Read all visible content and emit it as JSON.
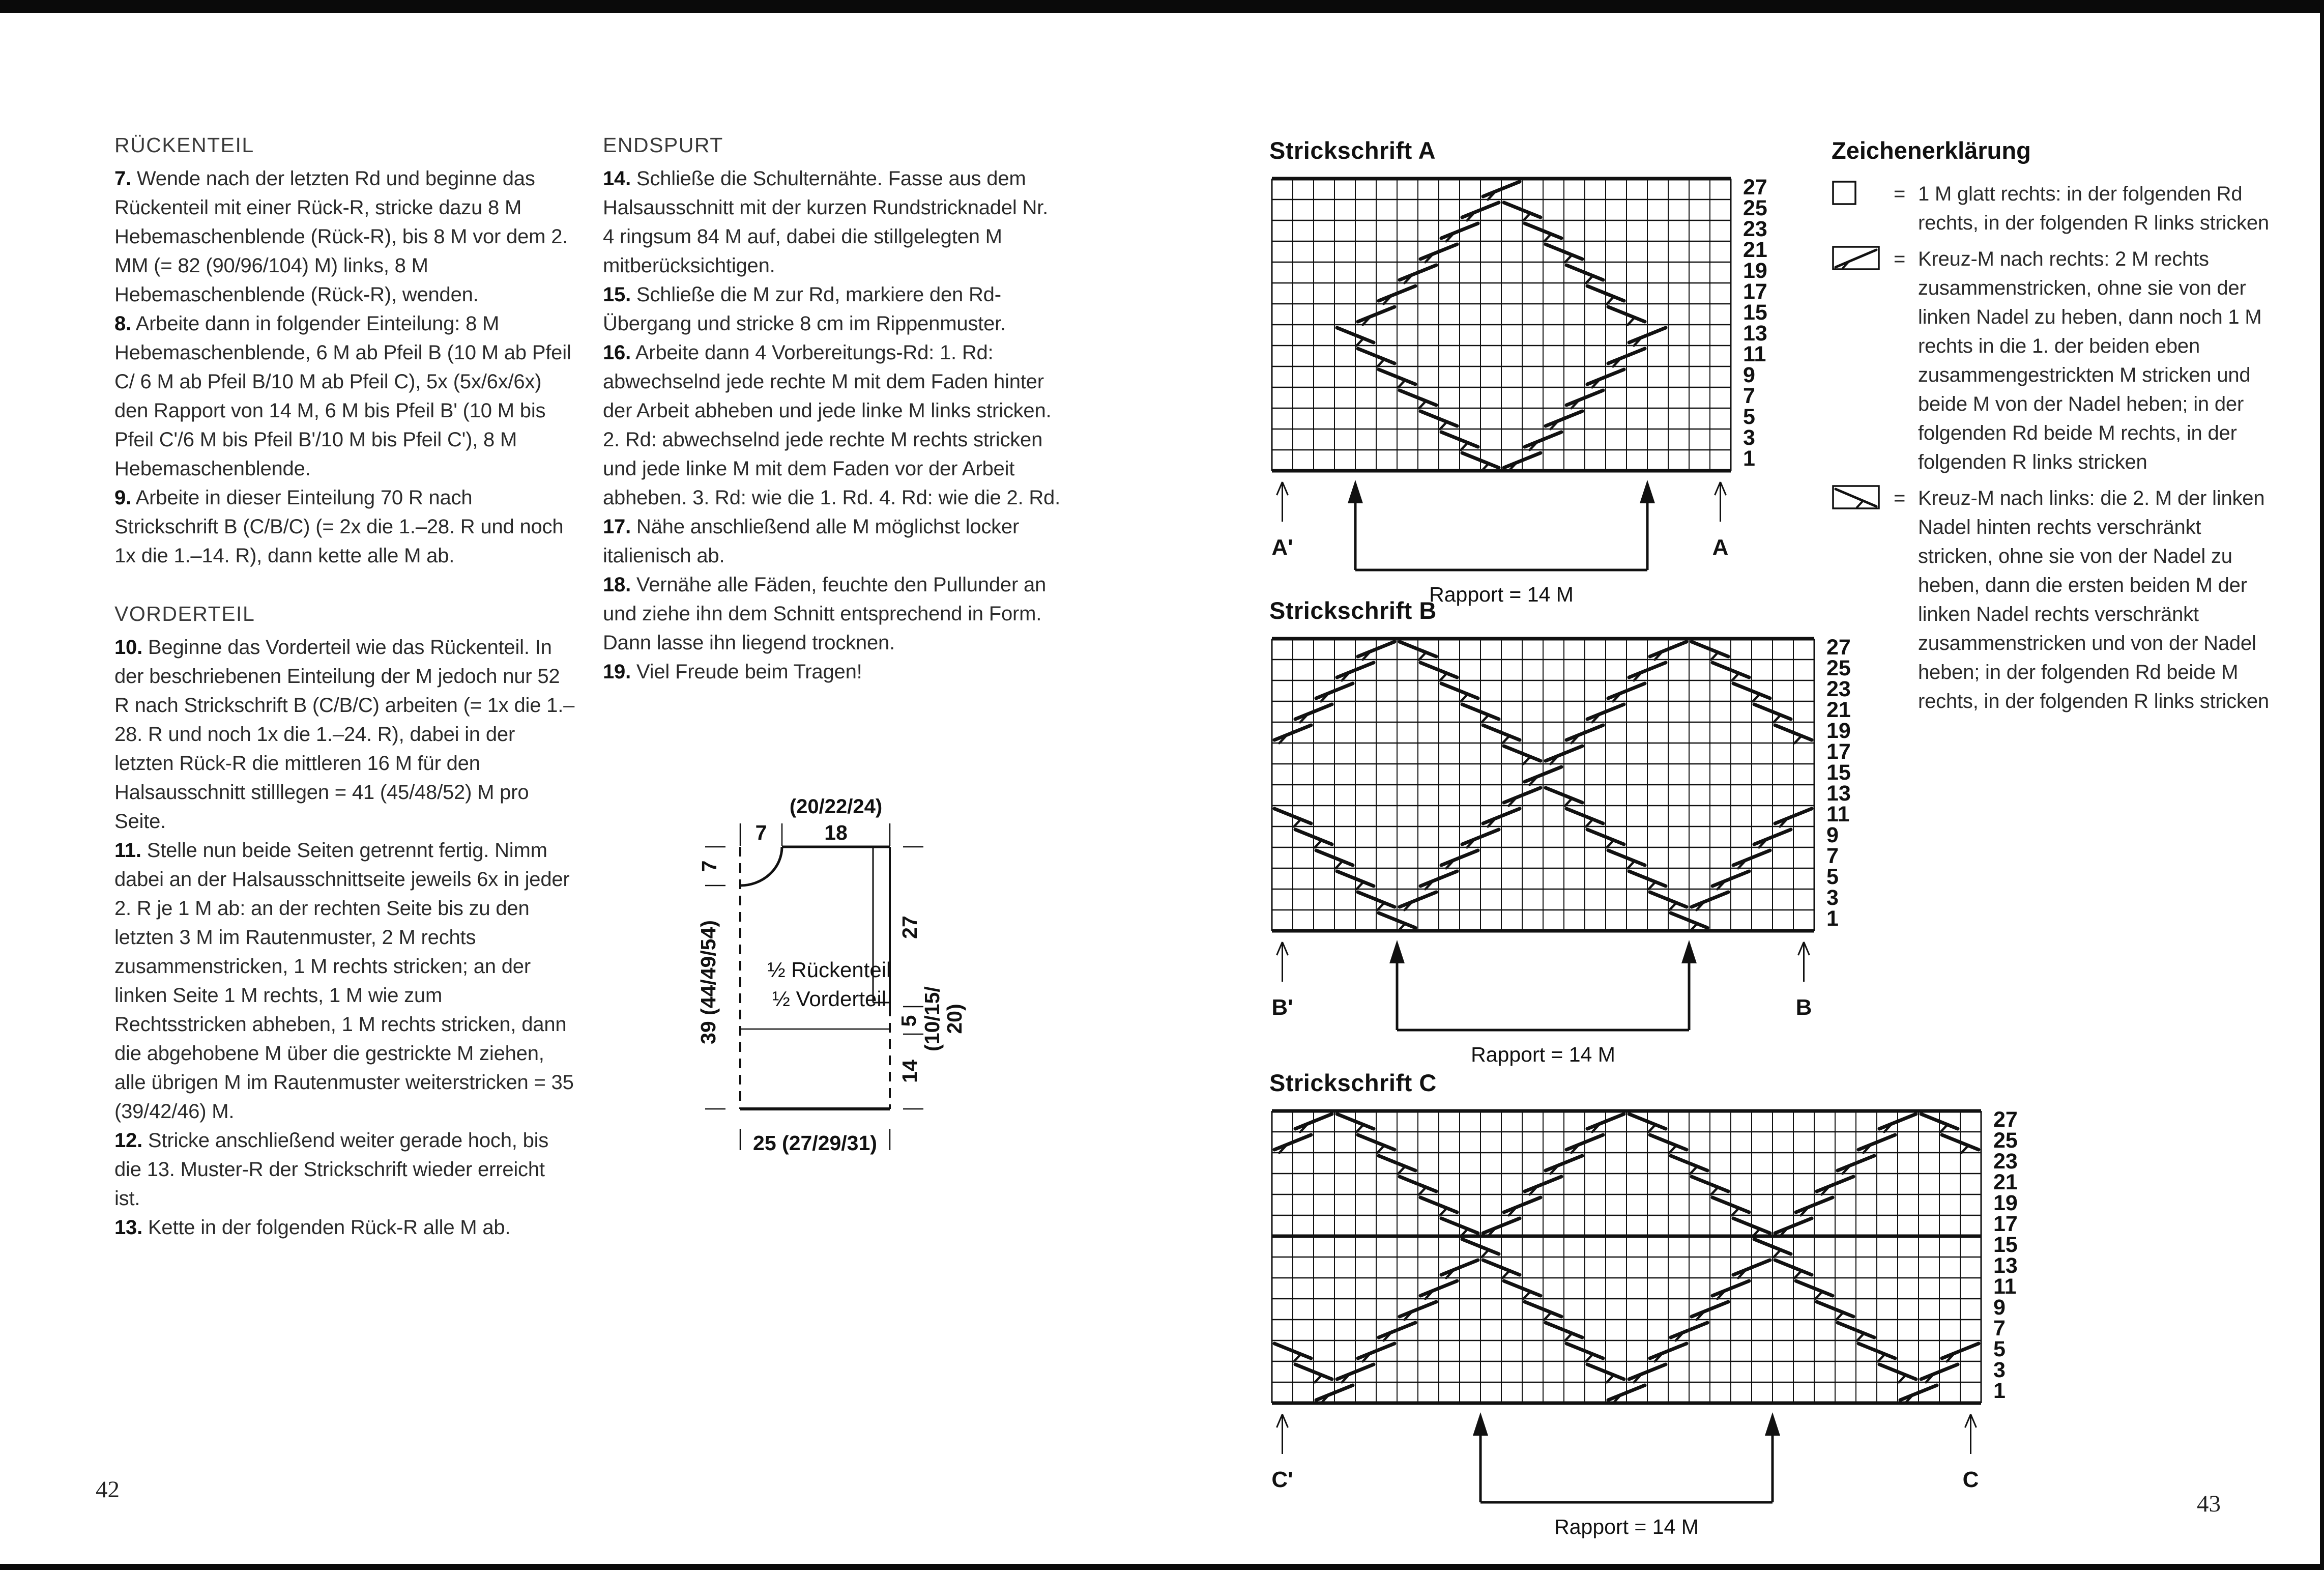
{
  "page_left": {
    "number": "42",
    "sections": [
      {
        "heading": "RÜCKENTEIL",
        "steps": [
          {
            "num": "7.",
            "text": "Wende nach der letzten Rd und beginne das Rückenteil mit einer Rück-R, stricke dazu 8 M Hebemaschenblende (Rück-R), bis 8 M vor dem 2. MM (= 82 (90/96/104) M) links, 8 M Hebemaschenblende (Rück-R), wenden."
          },
          {
            "num": "8.",
            "text": "Arbeite dann in folgender Einteilung: 8 M Hebemaschenblende, 6 M ab Pfeil B (10 M ab Pfeil C/ 6 M ab Pfeil B/10 M ab Pfeil C), 5x (5x/6x/6x) den Rapport von 14 M, 6 M bis Pfeil B' (10 M bis Pfeil C'/6 M bis Pfeil B'/10 M bis Pfeil C'), 8 M Hebemaschenblende."
          },
          {
            "num": "9.",
            "text": "Arbeite in dieser Einteilung 70 R nach Strickschrift B (C/B/C) (= 2x die 1.–28. R und noch 1x die 1.–14. R), dann kette alle M ab."
          }
        ]
      },
      {
        "heading": "VORDERTEIL",
        "steps": [
          {
            "num": "10.",
            "text": "Beginne das Vorderteil wie das Rückenteil. In der beschriebenen Einteilung der M jedoch nur 52 R nach Strickschrift B (C/B/C) arbeiten (= 1x die 1.–28. R und noch 1x die 1.–24. R), dabei in der letzten Rück-R die mittleren 16 M für den Halsausschnitt stilllegen = 41 (45/48/52) M pro Seite."
          },
          {
            "num": "11.",
            "text": "Stelle nun beide Seiten getrennt fertig. Nimm dabei an der Halsausschnittseite jeweils 6x in jeder 2. R je 1 M ab: an der rechten Seite bis zu den letzten 3 M im Rautenmuster, 2 M rechts zusammenstricken, 1 M rechts stricken; an der linken Seite 1 M rechts, 1 M wie zum Rechtsstricken abheben, 1 M rechts stricken, dann die abgehobene M über die gestrickte M ziehen, alle übrigen M im Rautenmuster weiterstricken = 35 (39/42/46) M."
          },
          {
            "num": "12.",
            "text": "Stricke anschließend weiter gerade hoch, bis die 13. Muster-R der Strickschrift wieder erreicht ist."
          },
          {
            "num": "13.",
            "text": "Kette in der folgenden Rück-R alle M ab."
          }
        ]
      }
    ]
  },
  "page_mid": {
    "sections": [
      {
        "heading": "ENDSPURT",
        "steps": [
          {
            "num": "14.",
            "text": "Schließe die Schulternähte. Fasse aus dem Halsausschnitt mit der kurzen Rundstricknadel Nr. 4 ringsum 84 M auf, dabei die stillgelegten M mitberücksichtigen."
          },
          {
            "num": "15.",
            "text": "Schließe die M zur Rd, markiere den Rd-Übergang und stricke 8 cm im Rippenmuster."
          },
          {
            "num": "16.",
            "text": "Arbeite dann 4 Vorbereitungs-Rd: 1. Rd: abwechselnd jede rechte M mit dem Faden hinter der Arbeit abheben und jede linke M links stricken. 2. Rd: abwechselnd jede rechte M rechts stricken und jede linke M mit dem Faden vor der Arbeit abheben. 3. Rd: wie die 1. Rd. 4. Rd: wie die 2. Rd."
          },
          {
            "num": "17.",
            "text": "Nähe anschließend alle M möglichst locker italienisch ab."
          },
          {
            "num": "18.",
            "text": "Vernähe alle Fäden, feuchte den Pullunder an und ziehe ihn dem Schnitt entsprechend in Form. Dann lasse ihn liegend trocknen."
          },
          {
            "num": "19.",
            "text": "Viel Freude beim Tragen!"
          }
        ]
      }
    ]
  },
  "schematic": {
    "top_group": "(20/22/24)",
    "top_width": "18",
    "top_left": "7",
    "left_small": "7",
    "left_total": "39 (44/49/54)",
    "right_upper": "27",
    "right_mid_num": "5",
    "right_mid_paren1": "(10/15/",
    "right_mid_paren2": "20)",
    "right_lower": "14",
    "bottom": "25 (27/29/31)",
    "inner_line1": "½ Rückenteil",
    "inner_line2": "½ Vorderteil"
  },
  "page_right": {
    "number": "43",
    "legend": {
      "title": "Zeichenerklärung",
      "items": [
        {
          "symbol": "empty-square",
          "eq": "=",
          "text": "1 M glatt rechts: in der folgenden Rd rechts, in der folgenden R links stricken"
        },
        {
          "symbol": "cross-right",
          "eq": "=",
          "text": "Kreuz-M nach rechts: 2 M rechts zusammenstricken, ohne sie von der linken Nadel zu heben, dann noch 1 M rechts in die 1. der beiden eben zusammengestrickten M stricken und beide M von der Nadel heben; in der folgenden Rd beide M rechts, in der folgenden R links stricken"
        },
        {
          "symbol": "cross-left",
          "eq": "=",
          "text": "Kreuz-M nach links: die 2. M der linken Nadel hinten rechts verschränkt stricken, ohne sie von der Nadel zu heben, dann die ersten beiden M der linken Nadel rechts verschränkt zusammenstricken und von der Nadel heben; in der folgenden Rd beide M rechts, in der folgenden R links stricken"
        }
      ]
    },
    "charts": [
      {
        "id": "A",
        "title": "Strickschrift A",
        "pos": [
          2495,
          268
        ],
        "cols": 22,
        "rows": [
          27,
          25,
          23,
          21,
          19,
          17,
          15,
          13,
          11,
          9,
          7,
          5,
          3,
          1
        ],
        "arrow_labels": [
          "A'",
          "A"
        ],
        "rapport_bounds": [
          4,
          18
        ],
        "rapport_label": "Rapport = 14 M",
        "strokes": [
          [
            27,
            11,
            "r"
          ],
          [
            25,
            10,
            "r"
          ],
          [
            25,
            12,
            "l"
          ],
          [
            23,
            9,
            "r"
          ],
          [
            23,
            13,
            "l"
          ],
          [
            21,
            8,
            "r"
          ],
          [
            21,
            14,
            "l"
          ],
          [
            19,
            7,
            "r"
          ],
          [
            19,
            15,
            "l"
          ],
          [
            17,
            6,
            "r"
          ],
          [
            17,
            16,
            "l"
          ],
          [
            15,
            5,
            "r"
          ],
          [
            15,
            17,
            "l"
          ],
          [
            13,
            4,
            "l"
          ],
          [
            13,
            18,
            "r"
          ],
          [
            11,
            5,
            "l"
          ],
          [
            11,
            17,
            "r"
          ],
          [
            9,
            6,
            "l"
          ],
          [
            9,
            16,
            "r"
          ],
          [
            7,
            7,
            "l"
          ],
          [
            7,
            15,
            "r"
          ],
          [
            5,
            8,
            "l"
          ],
          [
            5,
            14,
            "r"
          ],
          [
            3,
            9,
            "l"
          ],
          [
            3,
            13,
            "r"
          ],
          [
            1,
            10,
            "l"
          ],
          [
            1,
            12,
            "r"
          ]
        ]
      },
      {
        "id": "B",
        "title": "Strickschrift B",
        "pos": [
          2495,
          1172
        ],
        "cols": 26,
        "rows": [
          27,
          25,
          23,
          21,
          19,
          17,
          15,
          13,
          11,
          9,
          7,
          5,
          3,
          1
        ],
        "arrow_labels": [
          "B'",
          "B"
        ],
        "rapport_bounds": [
          6,
          20
        ],
        "rapport_label": "Rapport = 14 M",
        "strokes": [
          [
            27,
            5,
            "r"
          ],
          [
            27,
            7,
            "l"
          ],
          [
            27,
            19,
            "r"
          ],
          [
            27,
            21,
            "l"
          ],
          [
            25,
            4,
            "r"
          ],
          [
            25,
            8,
            "l"
          ],
          [
            25,
            18,
            "r"
          ],
          [
            25,
            22,
            "l"
          ],
          [
            23,
            3,
            "r"
          ],
          [
            23,
            9,
            "l"
          ],
          [
            23,
            17,
            "r"
          ],
          [
            23,
            23,
            "l"
          ],
          [
            21,
            2,
            "r"
          ],
          [
            21,
            10,
            "l"
          ],
          [
            21,
            16,
            "r"
          ],
          [
            21,
            24,
            "l"
          ],
          [
            19,
            1,
            "r"
          ],
          [
            19,
            11,
            "l"
          ],
          [
            19,
            15,
            "r"
          ],
          [
            19,
            25,
            "l"
          ],
          [
            17,
            12,
            "l"
          ],
          [
            17,
            14,
            "r"
          ],
          [
            15,
            13,
            "r"
          ],
          [
            13,
            12,
            "r"
          ],
          [
            13,
            14,
            "l"
          ],
          [
            11,
            1,
            "l"
          ],
          [
            11,
            11,
            "r"
          ],
          [
            11,
            15,
            "l"
          ],
          [
            11,
            25,
            "r"
          ],
          [
            9,
            2,
            "l"
          ],
          [
            9,
            10,
            "r"
          ],
          [
            9,
            16,
            "l"
          ],
          [
            9,
            24,
            "r"
          ],
          [
            7,
            3,
            "l"
          ],
          [
            7,
            9,
            "r"
          ],
          [
            7,
            17,
            "l"
          ],
          [
            7,
            23,
            "r"
          ],
          [
            5,
            4,
            "l"
          ],
          [
            5,
            8,
            "r"
          ],
          [
            5,
            18,
            "l"
          ],
          [
            5,
            22,
            "r"
          ],
          [
            3,
            5,
            "l"
          ],
          [
            3,
            7,
            "r"
          ],
          [
            3,
            19,
            "l"
          ],
          [
            3,
            21,
            "r"
          ],
          [
            1,
            6,
            "l"
          ],
          [
            1,
            20,
            "l"
          ]
        ]
      },
      {
        "id": "C",
        "title": "Strickschrift C",
        "pos": [
          2495,
          2100
        ],
        "cols": 34,
        "rows": [
          27,
          25,
          23,
          21,
          19,
          17,
          15,
          13,
          11,
          9,
          7,
          5,
          3,
          1
        ],
        "bold_after_row": 17,
        "arrow_labels": [
          "C'",
          "C"
        ],
        "rapport_bounds": [
          10,
          24
        ],
        "rapport_label": "Rapport = 14 M",
        "strokes": [
          [
            27,
            2,
            "r"
          ],
          [
            27,
            4,
            "l"
          ],
          [
            27,
            16,
            "r"
          ],
          [
            27,
            18,
            "l"
          ],
          [
            27,
            30,
            "r"
          ],
          [
            27,
            32,
            "l"
          ],
          [
            25,
            1,
            "r"
          ],
          [
            25,
            5,
            "l"
          ],
          [
            25,
            15,
            "r"
          ],
          [
            25,
            19,
            "l"
          ],
          [
            25,
            29,
            "r"
          ],
          [
            25,
            33,
            "l"
          ],
          [
            23,
            6,
            "l"
          ],
          [
            23,
            14,
            "r"
          ],
          [
            23,
            20,
            "l"
          ],
          [
            23,
            28,
            "r"
          ],
          [
            21,
            7,
            "l"
          ],
          [
            21,
            13,
            "r"
          ],
          [
            21,
            21,
            "l"
          ],
          [
            21,
            27,
            "r"
          ],
          [
            19,
            8,
            "l"
          ],
          [
            19,
            12,
            "r"
          ],
          [
            19,
            22,
            "l"
          ],
          [
            19,
            26,
            "r"
          ],
          [
            17,
            9,
            "l"
          ],
          [
            17,
            11,
            "r"
          ],
          [
            17,
            23,
            "l"
          ],
          [
            17,
            25,
            "r"
          ],
          [
            15,
            10,
            "l"
          ],
          [
            15,
            24,
            "l"
          ],
          [
            13,
            9,
            "r"
          ],
          [
            13,
            11,
            "l"
          ],
          [
            13,
            23,
            "r"
          ],
          [
            13,
            25,
            "l"
          ],
          [
            11,
            8,
            "r"
          ],
          [
            11,
            12,
            "l"
          ],
          [
            11,
            22,
            "r"
          ],
          [
            11,
            26,
            "l"
          ],
          [
            9,
            7,
            "r"
          ],
          [
            9,
            13,
            "l"
          ],
          [
            9,
            21,
            "r"
          ],
          [
            9,
            27,
            "l"
          ],
          [
            7,
            6,
            "r"
          ],
          [
            7,
            14,
            "l"
          ],
          [
            7,
            20,
            "r"
          ],
          [
            7,
            28,
            "l"
          ],
          [
            5,
            1,
            "l"
          ],
          [
            5,
            5,
            "r"
          ],
          [
            5,
            15,
            "l"
          ],
          [
            5,
            19,
            "r"
          ],
          [
            5,
            29,
            "l"
          ],
          [
            5,
            33,
            "r"
          ],
          [
            3,
            2,
            "l"
          ],
          [
            3,
            4,
            "r"
          ],
          [
            3,
            16,
            "l"
          ],
          [
            3,
            18,
            "r"
          ],
          [
            3,
            30,
            "l"
          ],
          [
            3,
            32,
            "r"
          ],
          [
            1,
            3,
            "r"
          ],
          [
            1,
            17,
            "r"
          ],
          [
            1,
            31,
            "r"
          ]
        ]
      }
    ]
  }
}
